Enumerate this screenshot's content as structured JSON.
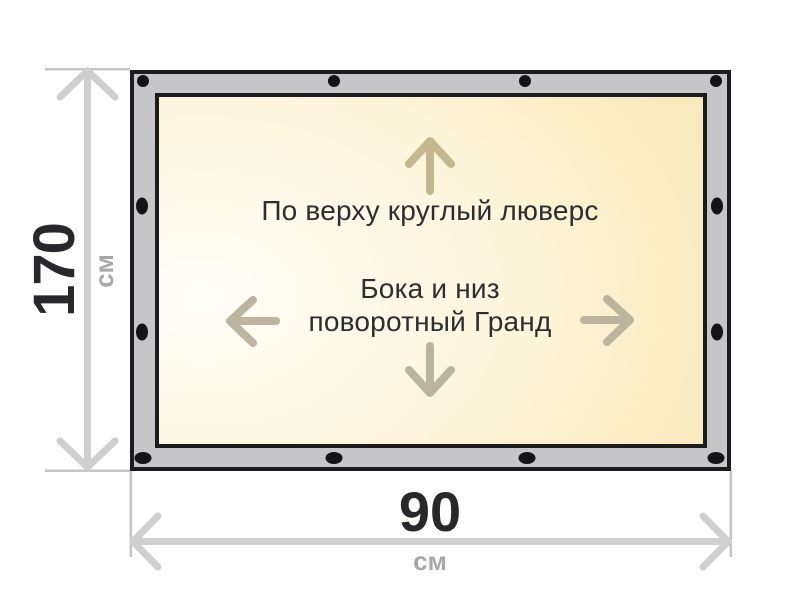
{
  "banner": {
    "top_note": "По верху круглый люверс",
    "middle_note_line1": "Бока и низ",
    "middle_note_line2": "поворотный Гранд"
  },
  "dimensions": {
    "height": {
      "value": "170",
      "unit": "см"
    },
    "width": {
      "value": "90",
      "unit": "см"
    }
  },
  "icons": {
    "inner_arrows": [
      "up-arrow-icon",
      "down-arrow-icon",
      "left-arrow-icon",
      "right-arrow-icon"
    ],
    "dimension_arrows": [
      "height-dimension-arrow",
      "width-dimension-arrow"
    ],
    "grommets": "grommet-dot"
  },
  "colors": {
    "frame_gray": "#c6c6c8",
    "outline_black": "#1c1c1e",
    "grommet_black": "#141416",
    "canvas_light": "#fefdf8",
    "canvas_deep": "#f8e3a8",
    "inner_arrow_tan": "#c6b78f",
    "side_arrow_tan": "#bdb49d",
    "dimension_arrow_gray": "#cfcfcf",
    "extension_line_gray": "#c5c5c5",
    "value_text": "#28282c",
    "unit_text": "#a7a7aa",
    "note_text": "#2d2d2f"
  }
}
